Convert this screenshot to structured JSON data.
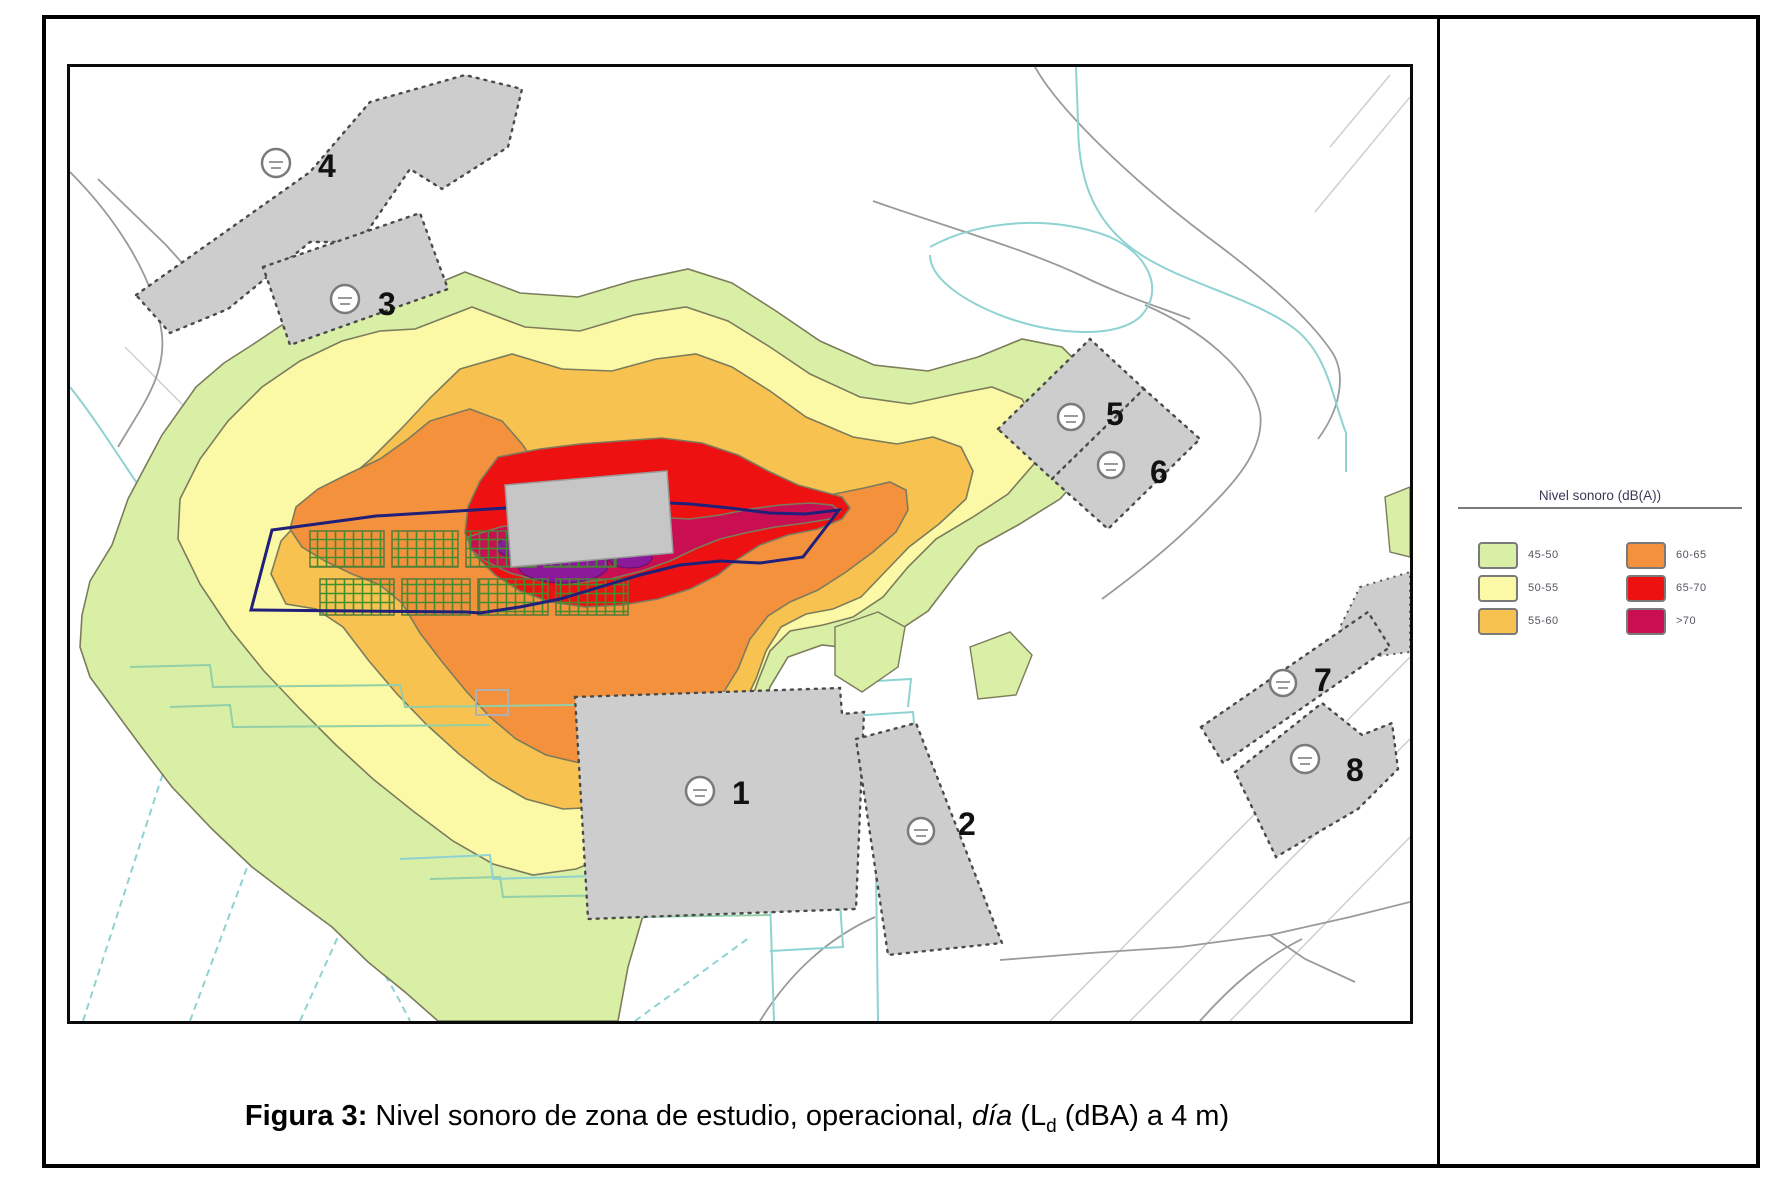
{
  "figure": {
    "caption": {
      "label": "Figura 3:",
      "text_main": " Nivel sonoro de zona de estudio, operacional, ",
      "text_italic": "día",
      "text_after": " (L",
      "subscript": "d",
      "text_end": " (dBA) a 4 m)"
    }
  },
  "legend": {
    "title": "Nivel sonoro (dB(A))",
    "items": [
      {
        "range": "45-50",
        "color": "#d8efa5"
      },
      {
        "range": "50-55",
        "color": "#fbf9a6"
      },
      {
        "range": "55-60",
        "color": "#f7c24f"
      },
      {
        "range": "60-65",
        "color": "#f4913d"
      },
      {
        "range": "65-70",
        "color": "#ee1111"
      },
      {
        "range": ">70",
        "color": "#ca0e52"
      }
    ]
  },
  "map": {
    "buildings": [
      {
        "label": "1"
      },
      {
        "label": "2"
      },
      {
        "label": "3"
      },
      {
        "label": "4"
      },
      {
        "label": "5"
      },
      {
        "label": "6"
      },
      {
        "label": "7"
      },
      {
        "label": "8"
      }
    ],
    "colors": {
      "building_fill": "#cdcdcd",
      "source_building_fill": "#c6c6c6",
      "site_boundary": "#20207a",
      "hatch_green": "#3f8f2f",
      "purple_patch": "#8b1a9b",
      "stream_cyan": "#8ed2d2",
      "terrain_gray": "#9a9a9a"
    }
  }
}
